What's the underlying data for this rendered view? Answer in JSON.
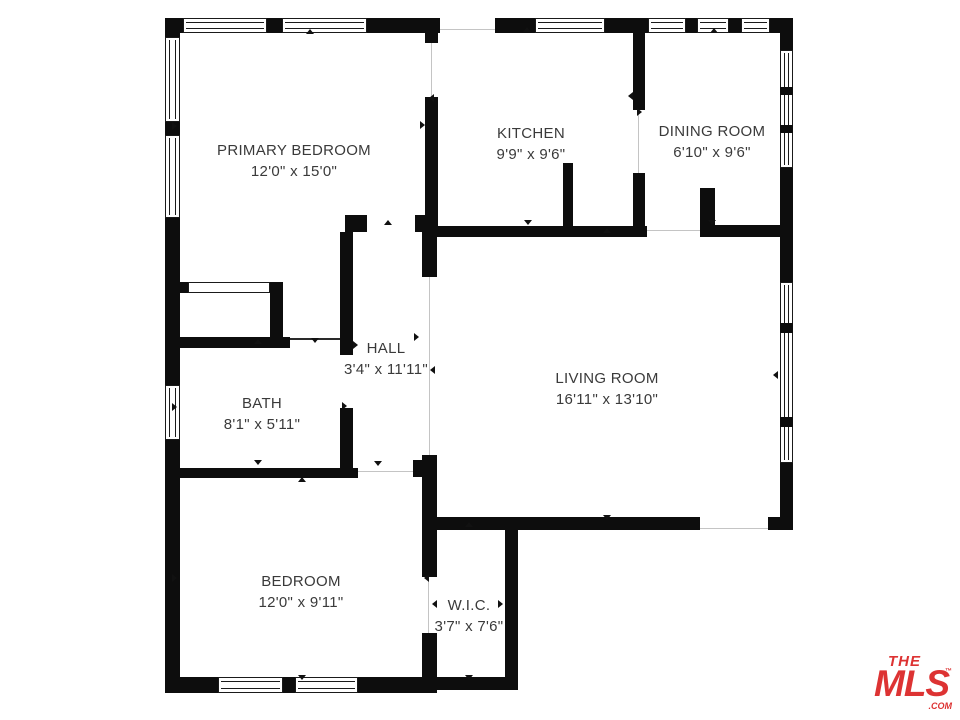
{
  "colors": {
    "wall": "#0d0d0d",
    "label_text": "#3a3a3a",
    "brand_red": "#dd3333"
  },
  "rooms": [
    {
      "id": "primary-bedroom",
      "name": "PRIMARY BEDROOM",
      "dimensions": "12'0\" x 15'0\""
    },
    {
      "id": "kitchen",
      "name": "KITCHEN",
      "dimensions": "9'9\" x 9'6\""
    },
    {
      "id": "dining-room",
      "name": "DINING ROOM",
      "dimensions": "6'10\" x 9'6\""
    },
    {
      "id": "hall",
      "name": "HALL",
      "dimensions": "3'4\" x 11'11\""
    },
    {
      "id": "bath",
      "name": "BATH",
      "dimensions": "8'1\" x 5'11\""
    },
    {
      "id": "living-room",
      "name": "LIVING ROOM",
      "dimensions": "16'11\" x 13'10\""
    },
    {
      "id": "bedroom",
      "name": "BEDROOM",
      "dimensions": "12'0\" x 9'11\""
    },
    {
      "id": "wic",
      "name": "W.I.C.",
      "dimensions": "3'7\" x 7'6\""
    }
  ],
  "logo": {
    "line1": "THE",
    "line2": "MLS",
    "trademark": "™",
    "suffix": ".COM"
  }
}
